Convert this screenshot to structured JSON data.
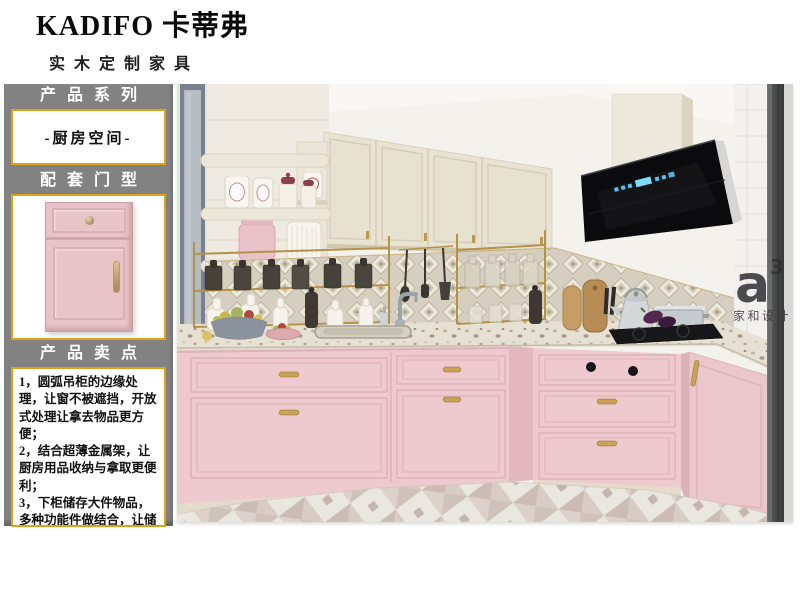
{
  "brand": {
    "logo": "KADIFO 卡蒂弗",
    "tagline": "实木定制家具"
  },
  "sidebar": {
    "series": {
      "title": "产品系列",
      "value": "-厨房空间-"
    },
    "door": {
      "title": "配套门型"
    },
    "selling": {
      "title": "产品卖点",
      "points": [
        "1，圆弧吊柜的边缘处理，让窗不被遮挡，开放式处理让拿去物品更方便；",
        "2，结合超薄金属架，让厨房用品收纳与拿取更便利；",
        "3，下柜储存大件物品，多种功能件做结合，让储存空间能合理利用；"
      ]
    }
  },
  "photo": {
    "watermark": {
      "mark": "a",
      "sup": "3",
      "caption": "家和设计"
    }
  },
  "colors": {
    "accent_gold": "#E2A117",
    "panel_gray": "#828282",
    "cabinet_pink": "#EEC9CD",
    "cabinet_cream": "#E9E3D2",
    "hood_black": "#0B0B0E",
    "led_blue": "#58C3F2"
  }
}
